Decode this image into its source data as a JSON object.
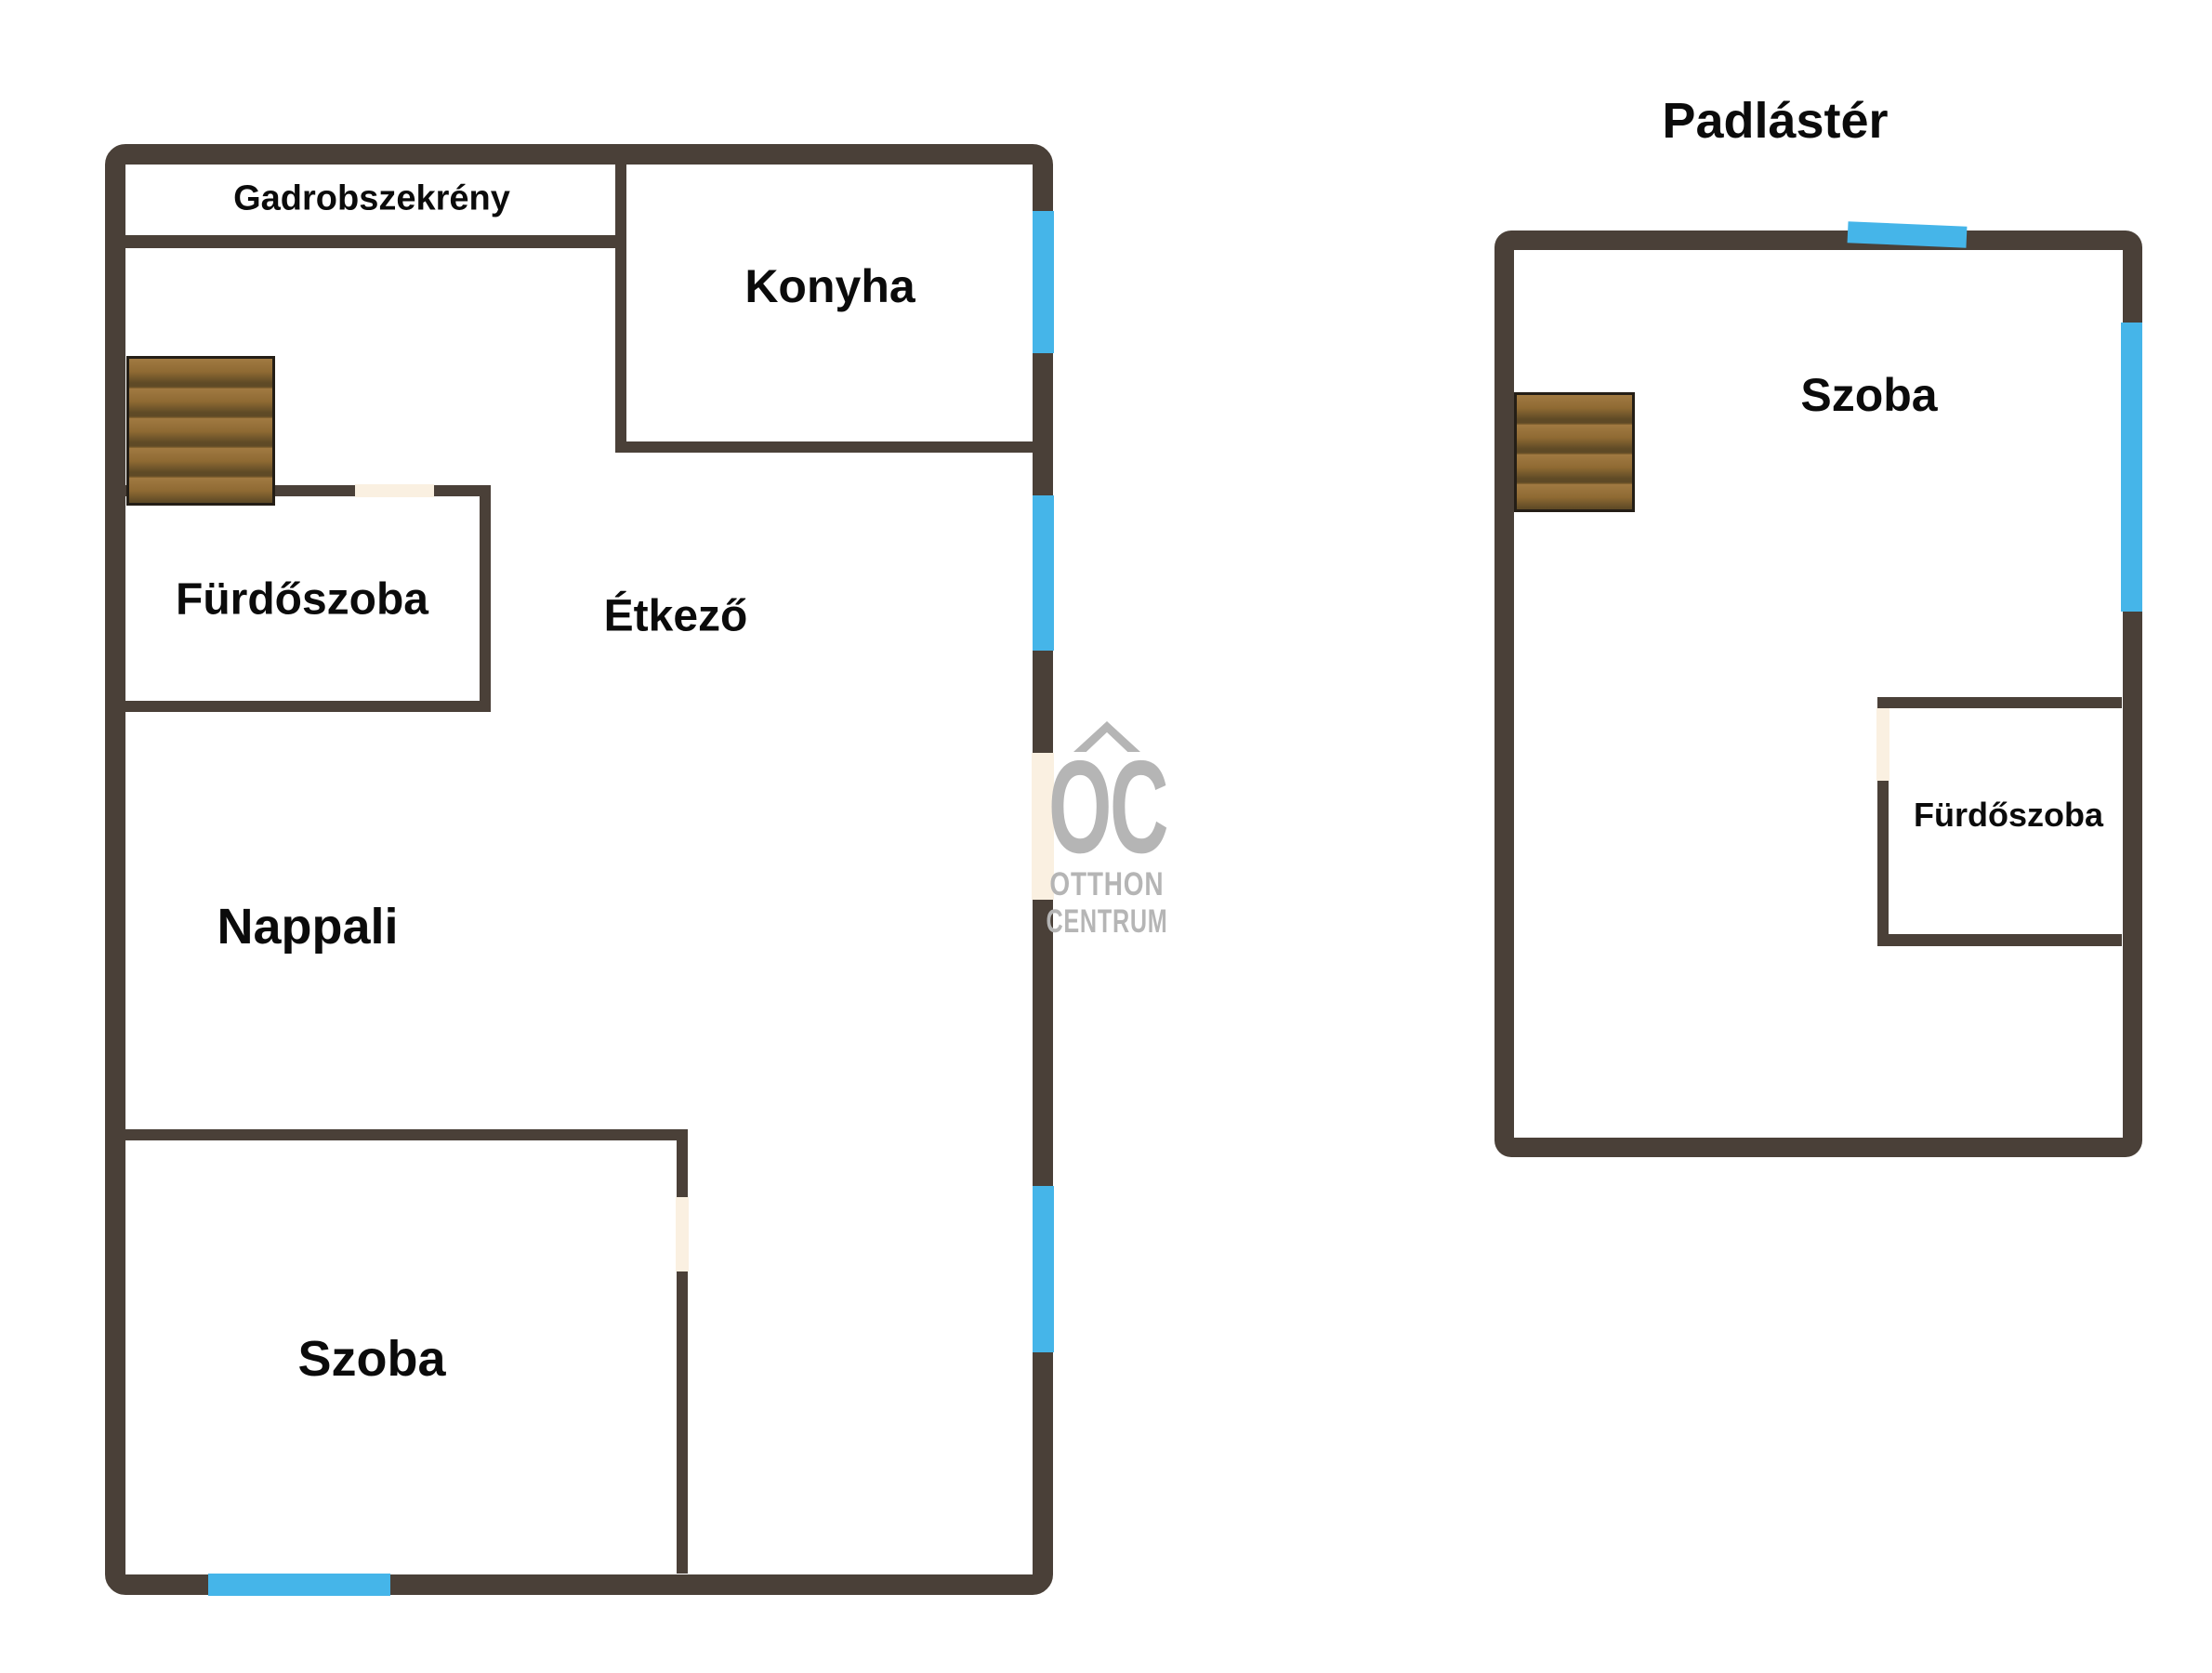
{
  "colors": {
    "background": "#ffffff",
    "wall": "#4a4038",
    "window": "#45b5e9",
    "door_opening": "#faf0e1",
    "wood": "#8f6a33",
    "wood_dark": "#5f4a26",
    "wood_light": "#a17a42",
    "wood_border": "#241e16",
    "text": "#0b0b0b",
    "watermark": "#b5b5b5"
  },
  "ground_floor": {
    "labels": {
      "wardrobe": "Gadrobszekrény",
      "kitchen": "Konyha",
      "bathroom": "Fürdőszoba",
      "dining": "Étkező",
      "living": "Nappali",
      "room": "Szoba"
    }
  },
  "attic": {
    "title": "Padlástér",
    "labels": {
      "room": "Szoba",
      "bathroom": "Fürdőszoba"
    }
  },
  "watermark": {
    "monogram": "OC",
    "word1": "OTTHON",
    "word2": "CENTRUM"
  }
}
